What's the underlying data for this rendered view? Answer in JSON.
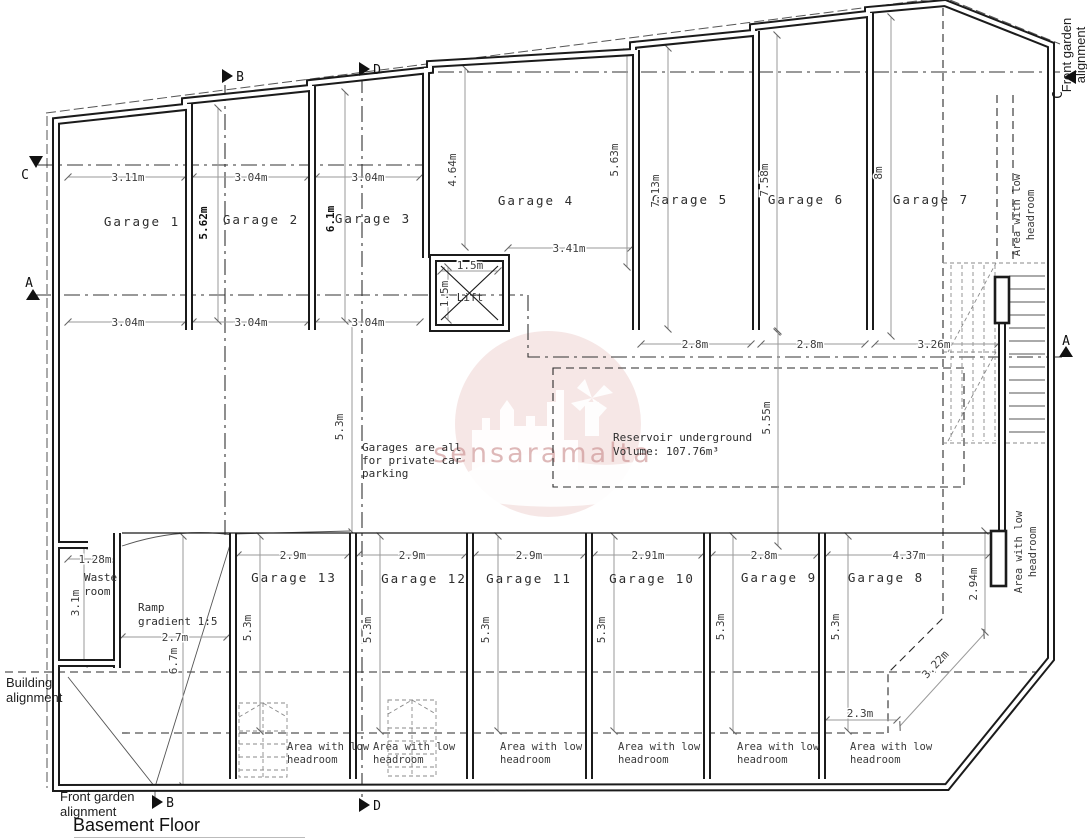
{
  "title": "Basement Floor",
  "watermark": "sensaramalta",
  "sections": {
    "a": "A",
    "b": "B",
    "c": "C",
    "d": "D"
  },
  "garages_top": [
    "Garage 1",
    "Garage 2",
    "Garage 3",
    "Garage 4",
    "Garage 5",
    "Garage 6",
    "Garage 7"
  ],
  "garages_bottom": [
    "Garage 13",
    "Garage 12",
    "Garage 11",
    "Garage 10",
    "Garage 9",
    "Garage 8"
  ],
  "rooms": {
    "lift": "Lift",
    "waste": [
      "Waste",
      "room"
    ],
    "ramp": [
      "Ramp",
      "gradient 1:5"
    ]
  },
  "low_headroom": [
    "Area with low",
    "headroom"
  ],
  "notes": {
    "garages": [
      "Garages are all",
      "for private car",
      "parking"
    ],
    "reservoir": [
      "Reservoir underground",
      "Volume: 107.76m³"
    ]
  },
  "alignments": {
    "building": [
      "Building",
      "alignment"
    ],
    "front_garden": [
      "Front garden",
      "alignment"
    ]
  },
  "dims": {
    "top_widths": [
      "3.11m",
      "3.04m",
      "3.04m"
    ],
    "mid_widths": [
      "3.04m",
      "3.04m",
      "3.04m"
    ],
    "right_widths": [
      "2.8m",
      "2.8m",
      "3.26m"
    ],
    "garage4_opening": "3.41m",
    "lift_w": "1.5m",
    "lift_h": "1.5m",
    "depth_g2": "5.62m",
    "depth_g3": "6.1m",
    "depth_g4a": "4.64m",
    "depth_g4b": "5.63m",
    "depth_g5": "7.13m",
    "depth_g6": "7.58m",
    "depth_g7": "8m",
    "aisle": "5.3m",
    "reservoir": "5.55m",
    "bottom_widths": [
      "2.9m",
      "2.9m",
      "2.9m",
      "2.91m",
      "2.8m",
      "4.37m"
    ],
    "bottom_depths": [
      "5.3m",
      "5.3m",
      "5.3m",
      "5.3m",
      "5.3m",
      "5.3m"
    ],
    "corner_v": "2.94m",
    "corner_diag": "3.22m",
    "corner_h": "2.3m",
    "waste_w": "1.28m",
    "waste_h": "3.1m",
    "ramp_w": "2.7m",
    "ramp_l": "6.7m"
  },
  "colors": {
    "line": "#1b1b1b",
    "dim": "#9a9a9a",
    "watermark_pink": "#c0544f",
    "watermark_text": "#c98b8b"
  }
}
